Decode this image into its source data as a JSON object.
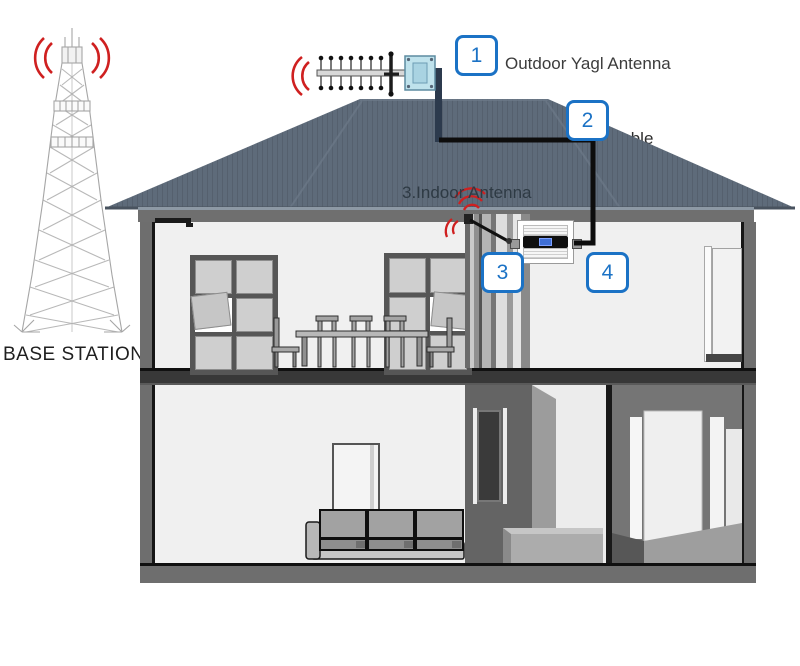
{
  "scene": {
    "base_station_label": "BASE STATION",
    "callouts": [
      {
        "number": "1",
        "label": "Outdoor Yagl Antenna"
      },
      {
        "number": "2",
        "label": "Cable"
      },
      {
        "number": "3",
        "label": "3.Indoor Antenna"
      },
      {
        "number": "4",
        "label": "Signal Booster"
      }
    ],
    "colors": {
      "callout_blue": "#1b72c5",
      "signal_red": "#cf2020",
      "roof_slate": "#5e6b7a",
      "cable_black": "#0d0d0d"
    }
  }
}
